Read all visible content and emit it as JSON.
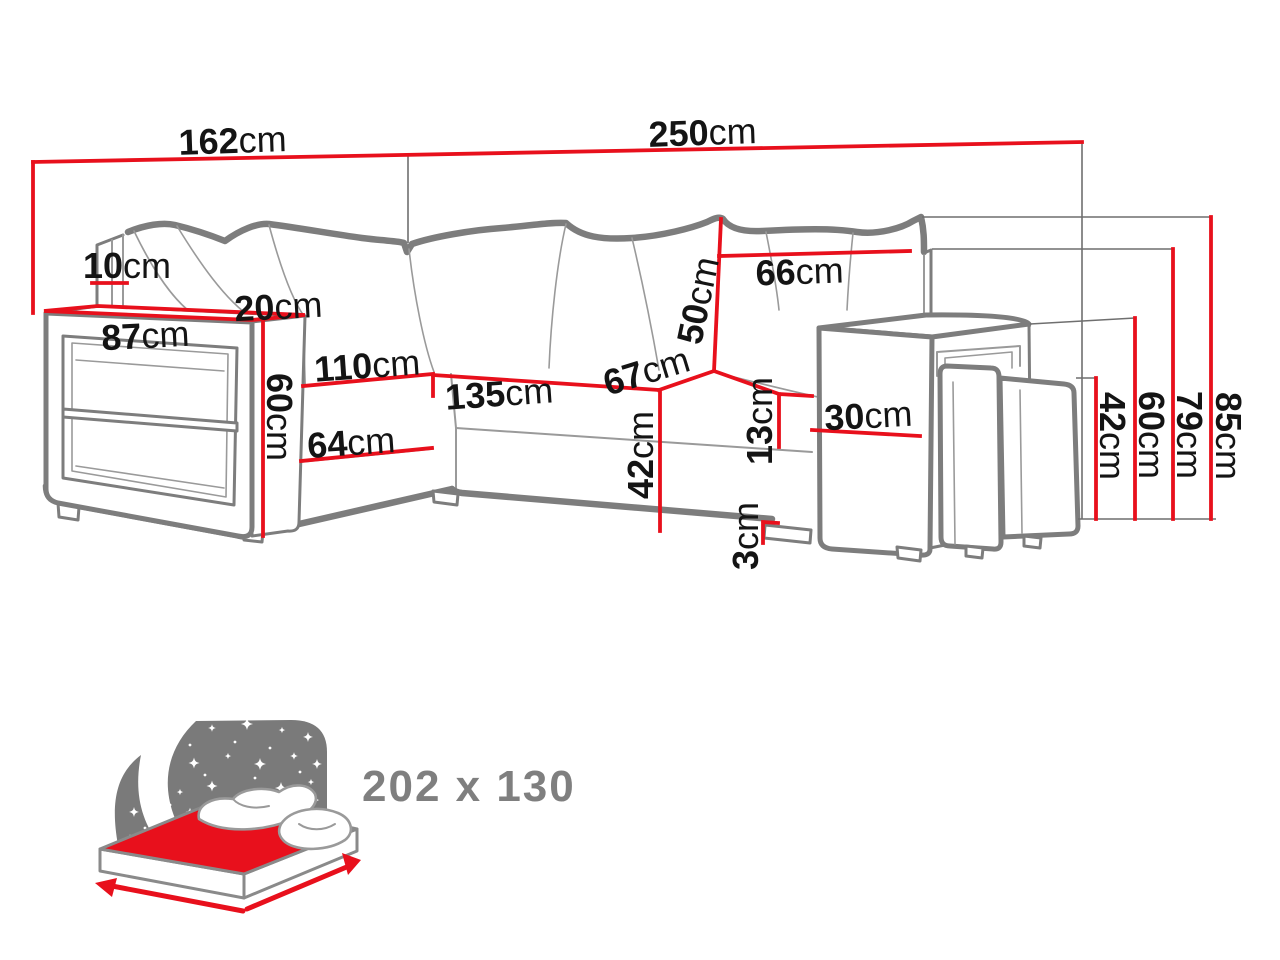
{
  "title": "Corner sofa bed dimension diagram",
  "unit": "cm",
  "colors": {
    "dimension-red": "#e8101c",
    "line-gray": "#7d7d7d",
    "line-light": "#9a9a9a",
    "text-dark": "#141414",
    "icon-gray": "#7a7a7a",
    "label-gray": "#7f7f7f"
  },
  "sofa_dimensions": {
    "labels": [
      {
        "id": "width-left-side",
        "value": "162",
        "unit": "cm"
      },
      {
        "id": "width-total",
        "value": "250",
        "unit": "cm"
      },
      {
        "id": "backrest-top-depth",
        "value": "10",
        "unit": "cm"
      },
      {
        "id": "armrest-top-depth",
        "value": "20",
        "unit": "cm"
      },
      {
        "id": "armrest-shelf-width",
        "value": "87",
        "unit": "cm"
      },
      {
        "id": "armrest-height",
        "value": "60",
        "unit": "cm"
      },
      {
        "id": "chaise-depth",
        "value": "110",
        "unit": "cm"
      },
      {
        "id": "chaise-seat-width",
        "value": "64",
        "unit": "cm"
      },
      {
        "id": "seat-width",
        "value": "135",
        "unit": "cm"
      },
      {
        "id": "seat-depth",
        "value": "67",
        "unit": "cm"
      },
      {
        "id": "back-cushion-height",
        "value": "50",
        "unit": "cm"
      },
      {
        "id": "back-cushion-width",
        "value": "66",
        "unit": "cm"
      },
      {
        "id": "seat-height-mid",
        "value": "42",
        "unit": "cm"
      },
      {
        "id": "seat-gap",
        "value": "13",
        "unit": "cm"
      },
      {
        "id": "foot-height",
        "value": "3",
        "unit": "cm"
      },
      {
        "id": "armrest-width",
        "value": "30",
        "unit": "cm"
      },
      {
        "id": "height-seat",
        "value": "42",
        "unit": "cm"
      },
      {
        "id": "height-armrest",
        "value": "60",
        "unit": "cm"
      },
      {
        "id": "height-backrest",
        "value": "79",
        "unit": "cm"
      },
      {
        "id": "height-total",
        "value": "85",
        "unit": "cm"
      }
    ]
  },
  "sleeping_area": {
    "label": "202 x 130"
  }
}
